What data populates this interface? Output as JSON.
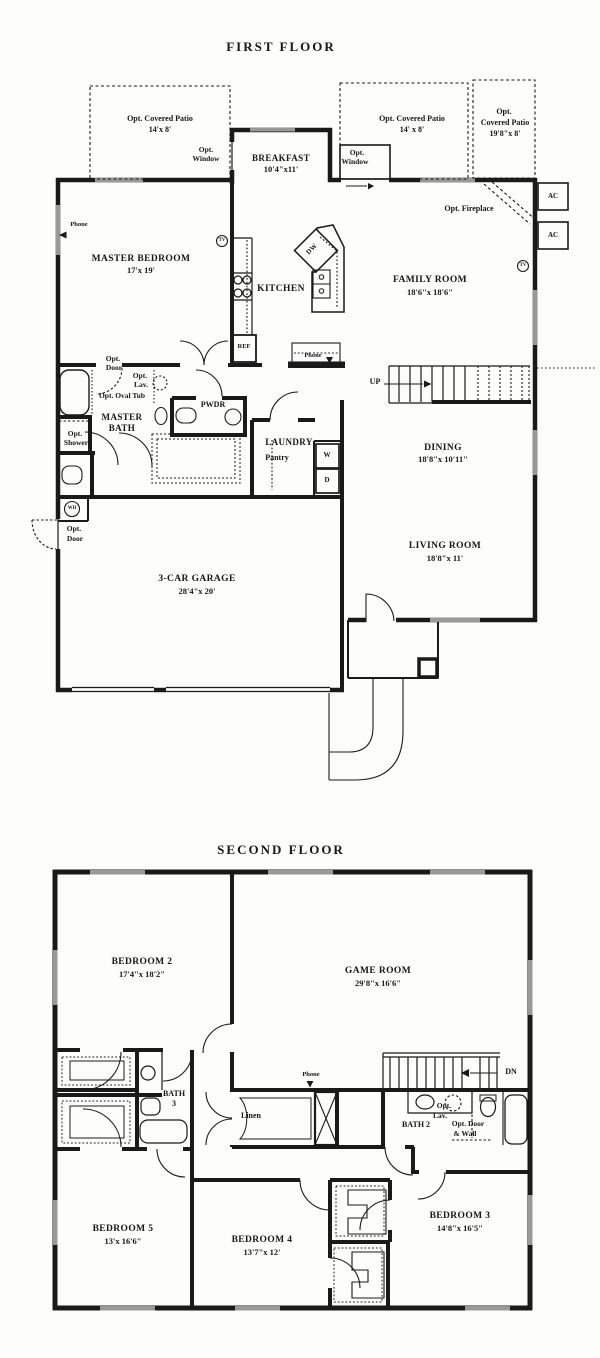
{
  "first_floor": {
    "title": "FIRST FLOOR",
    "labels": {
      "patio_left_1": "Opt. Covered Patio",
      "patio_left_2": "14'x 8'",
      "window_left_1": "Opt.",
      "window_left_2": "Window",
      "breakfast_1": "BREAKFAST",
      "breakfast_2": "10'4\"x11'",
      "window_right_1": "Opt.",
      "window_right_2": "Window",
      "patio_right_1": "Opt. Covered Patio",
      "patio_right_2": "14' x 8'",
      "patio_far_1": "Opt.",
      "patio_far_2": "Covered Patio",
      "patio_far_3": "19'8\"x 8'",
      "fireplace": "Opt. Fireplace",
      "ac": "AC",
      "phone": "Phone",
      "master_bedroom_1": "MASTER BEDROOM",
      "master_bedroom_2": "17'x 19'",
      "tv": "TV",
      "kitchen": "KITCHEN",
      "dw": "DW",
      "ref": "REF",
      "family_room_1": "FAMILY ROOM",
      "family_room_2": "18'6\"x 18'6\"",
      "up": "UP",
      "opt_door_1": "Opt.",
      "opt_door_2": "Door",
      "opt_lav_1": "Opt.",
      "opt_lav_2": "Lav.",
      "opt_oval_tub": "Opt. Oval Tub",
      "master_bath_1": "MASTER",
      "master_bath_2": "BATH",
      "opt_shower_1": "Opt.",
      "opt_shower_2": "Shower",
      "pwdr": "PWDR",
      "laundry": "LAUNDRY",
      "pantry": "Pantry",
      "washer": "W",
      "dryer": "D",
      "dining_1": "DINING",
      "dining_2": "18'8\"x 10'11\"",
      "living_1": "LIVING ROOM",
      "living_2": "18'8\"x 11'",
      "wh": "WH",
      "garage_opt_door_1": "Opt.",
      "garage_opt_door_2": "Door",
      "garage_1": "3-CAR GARAGE",
      "garage_2": "28'4\"x 20'"
    }
  },
  "second_floor": {
    "title": "SECOND FLOOR",
    "labels": {
      "bedroom2_1": "BEDROOM 2",
      "bedroom2_2": "17'4\"x 18'2\"",
      "game_room_1": "GAME ROOM",
      "game_room_2": "29'8\"x 16'6\"",
      "dn": "DN",
      "bath3_1": "BATH",
      "bath3_2": "3",
      "linen": "Linen",
      "phone": "Phone",
      "opt_lav_1": "Opt.",
      "opt_lav_2": "Lav.",
      "bath2": "BATH 2",
      "opt_door_wall_1": "Opt. Door",
      "opt_door_wall_2": "& Wall",
      "bedroom5_1": "BEDROOM 5",
      "bedroom5_2": "13'x 16'6\"",
      "bedroom4_1": "BEDROOM 4",
      "bedroom4_2": "13'7\"x 12'",
      "bedroom3_1": "BEDROOM 3",
      "bedroom3_2": "14'8\"x 16'5\""
    }
  },
  "colors": {
    "line": "#1a1a1a",
    "background": "#fdfdfb",
    "window_hatch": "#999999"
  }
}
